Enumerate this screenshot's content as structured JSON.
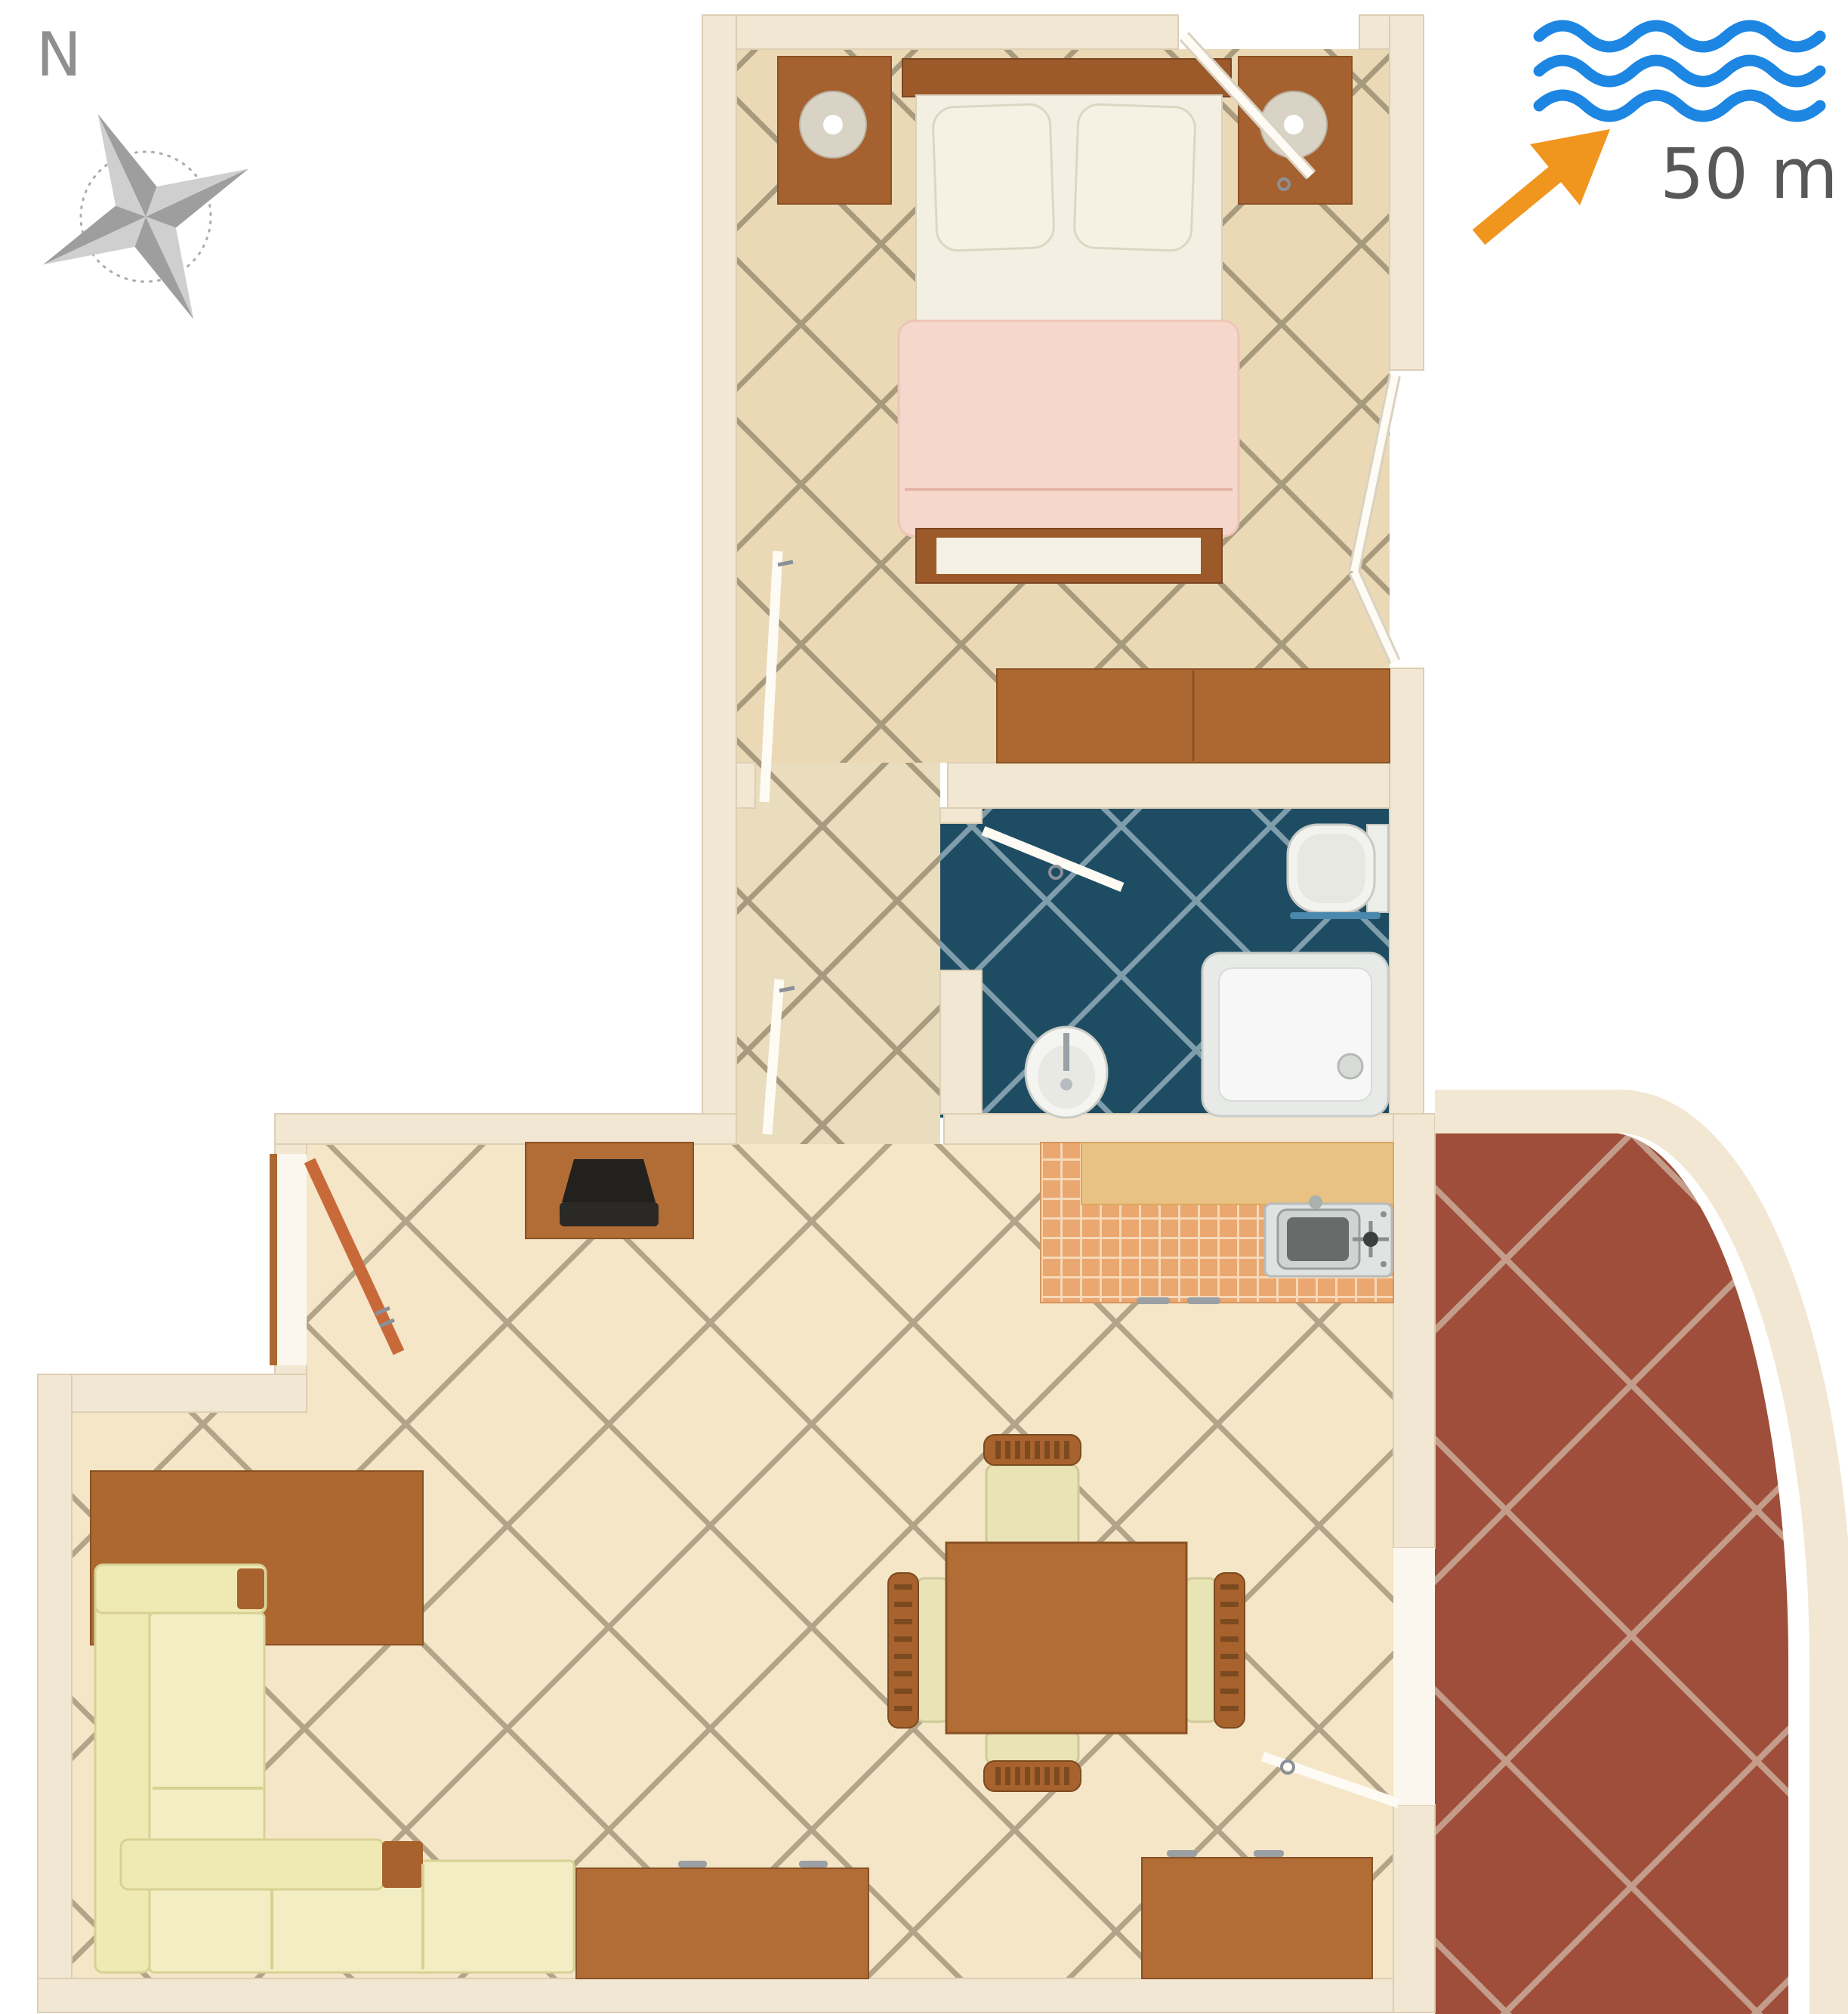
{
  "compass": {
    "label": "N"
  },
  "sea": {
    "distance_label": "50 m"
  },
  "icons": [
    {
      "name": "compass-rose-icon"
    },
    {
      "name": "sea-waves-icon"
    },
    {
      "name": "sea-direction-arrow-icon"
    }
  ],
  "palette": {
    "wave_blue": "#1d86e3",
    "arrow_orange": "#f0961e",
    "label_gray": "#58585a",
    "compass_gray": "#8f8f8f",
    "compass_light": "#cfcfcf",
    "compass_dark": "#9e9e9e",
    "wall_cream": "#f1e7d3",
    "floor_beige": "#f4e6c7",
    "bedroom_floor_tan": "#ebd9b6",
    "bath_tile_teal": "#1e4d63",
    "terrace_terracotta": "#9e4e3a",
    "kitchen_tile_orange": "#eaa76f",
    "wood_orange": "#b26c35",
    "wood_dark": "#9c5a2b",
    "sofa_cream": "#efe9b4",
    "blanket_pink": "#f6d7cb",
    "door_leaf_white": "#fdfbf4",
    "door_leaf_wood": "#c8693a"
  }
}
